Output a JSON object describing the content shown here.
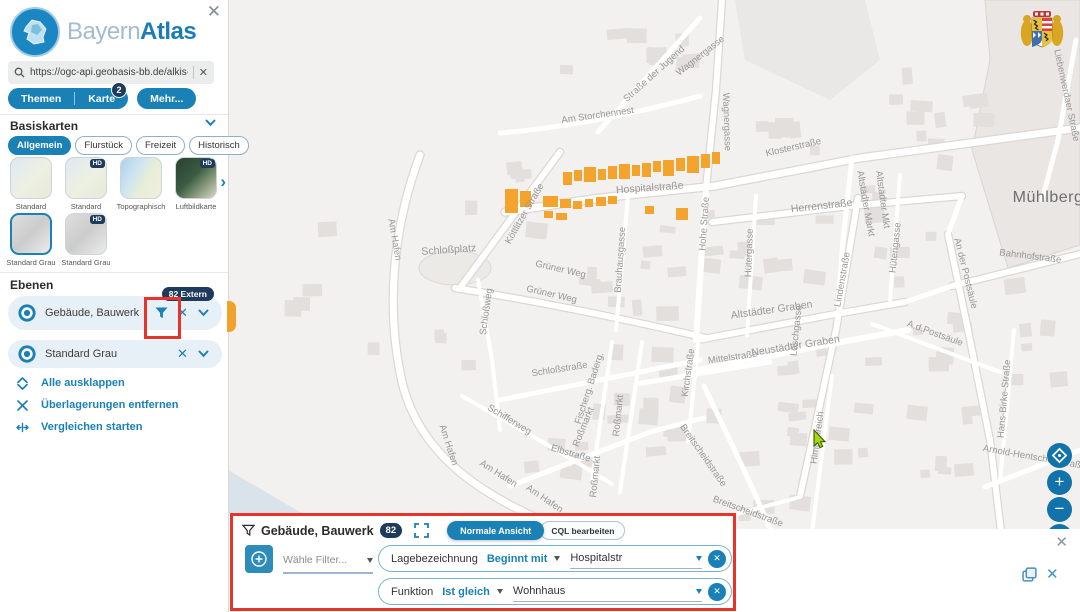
{
  "colors": {
    "brand": "#1a81b6",
    "badge_navy": "#1e3a5c",
    "highlight_orange": "#f4a42c",
    "annotation_red": "#e8332b"
  },
  "glyphs": {
    "close": "✕",
    "chevron_right": "›",
    "zoom_in": "+",
    "zoom_out": "−"
  },
  "sidebar": {
    "brand": {
      "part1": "Bayern",
      "part2": "Atlas"
    },
    "search": {
      "value": "https://ogc-api.geobasis-bb.de/alkis-verein"
    },
    "tabs": [
      {
        "label": "Themen",
        "badge": null
      },
      {
        "label": "Karte",
        "badge": "2"
      },
      {
        "label": "Mehr...",
        "badge": null
      }
    ],
    "basiskarten": {
      "title": "Basiskarten",
      "hd_badge": "HD",
      "chips": [
        {
          "label": "Allgemein",
          "active": true
        },
        {
          "label": "Flurstück",
          "active": false
        },
        {
          "label": "Freizeit",
          "active": false
        },
        {
          "label": "Historisch",
          "active": false
        }
      ],
      "thumbnails": [
        {
          "label": "Standard",
          "variant": "standard",
          "hd": false,
          "selected": false,
          "row": 1
        },
        {
          "label": "Standard",
          "variant": "standard",
          "hd": true,
          "selected": false,
          "row": 1
        },
        {
          "label": "Topographisch",
          "variant": "topo",
          "hd": false,
          "selected": false,
          "row": 1
        },
        {
          "label": "Luftbildkarte",
          "variant": "luft",
          "hd": true,
          "selected": false,
          "row": 1
        },
        {
          "label": "Standard Grau",
          "variant": "grau",
          "hd": false,
          "selected": true,
          "row": 2
        },
        {
          "label": "Standard Grau",
          "variant": "grau",
          "hd": true,
          "selected": false,
          "row": 2
        }
      ]
    },
    "ebenen": {
      "title": "Ebenen",
      "layers": [
        {
          "label": "Gebäude, Bauwerk",
          "badge": "82 Extern",
          "has_filter": true
        },
        {
          "label": "Standard Grau",
          "badge": null,
          "has_filter": false
        }
      ],
      "actions": [
        {
          "label": "Alle ausklappen",
          "icon": "expand-all-icon"
        },
        {
          "label": "Überlagerungen entfernen",
          "icon": "remove-overlays-icon"
        },
        {
          "label": "Vergleichen starten",
          "icon": "compare-icon"
        }
      ]
    }
  },
  "filter_panel": {
    "title": "Gebäude, Bauwerk",
    "count_badge": "82",
    "view_toggle": [
      {
        "label": "Normale Ansicht",
        "active": true
      },
      {
        "label": "CQL bearbeiten",
        "active": false
      }
    ],
    "add_filter_placeholder": "Wähle Filter...",
    "filters": [
      {
        "field": "Lagebezeichnung",
        "operator": "Beginnt mit",
        "value": "Hospitalstr"
      },
      {
        "field": "Funktion",
        "operator": "Ist gleich",
        "value": "Wohnhaus"
      }
    ]
  },
  "map": {
    "place_labels": [
      {
        "text": "Mühlberg",
        "x": 1048,
        "y": 202,
        "rot": 0,
        "size": 16
      }
    ],
    "street_labels": [
      {
        "text": "Wagnergasse",
        "x": 702,
        "y": 58,
        "rot": -38
      },
      {
        "text": "Wagnergasse",
        "x": 724,
        "y": 122,
        "rot": 88
      },
      {
        "text": "Straße der Jugend",
        "x": 656,
        "y": 76,
        "rot": -42
      },
      {
        "text": "Am Storchennest",
        "x": 598,
        "y": 118,
        "rot": -8
      },
      {
        "text": "Klosterstraße",
        "x": 794,
        "y": 150,
        "rot": -13
      },
      {
        "text": "Hospitalstraße",
        "x": 650,
        "y": 191,
        "rot": -4,
        "size": 10.5
      },
      {
        "text": "Herrenstraße",
        "x": 822,
        "y": 209,
        "rot": -6,
        "size": 10.5
      },
      {
        "text": "Altstädter Markt",
        "x": 863,
        "y": 204,
        "rot": 80
      },
      {
        "text": "Altstädter Mkt",
        "x": 880,
        "y": 200,
        "rot": 82
      },
      {
        "text": "Liebenwerdaer Straße",
        "x": 1064,
        "y": 96,
        "rot": 78
      },
      {
        "text": "Hohe Straße",
        "x": 707,
        "y": 224,
        "rot": -86
      },
      {
        "text": "Hütergasse",
        "x": 752,
        "y": 253,
        "rot": -88
      },
      {
        "text": "Hütengasse",
        "x": 898,
        "y": 248,
        "rot": -84
      },
      {
        "text": "Brauhausgasse",
        "x": 623,
        "y": 260,
        "rot": -86
      },
      {
        "text": "Köttlitzer Straße",
        "x": 527,
        "y": 215,
        "rot": -60
      },
      {
        "text": "Schloßplatz",
        "x": 449,
        "y": 253,
        "rot": -4,
        "size": 10.5
      },
      {
        "text": "Grüner Weg",
        "x": 560,
        "y": 272,
        "rot": 13
      },
      {
        "text": "Grüner Weg",
        "x": 551,
        "y": 297,
        "rot": 13
      },
      {
        "text": "Schloßweg",
        "x": 489,
        "y": 312,
        "rot": -82
      },
      {
        "text": "Am Hafen",
        "x": 392,
        "y": 240,
        "rot": 80
      },
      {
        "text": "Altstädter Graben",
        "x": 772,
        "y": 313,
        "rot": -8,
        "size": 10.5
      },
      {
        "text": "Neustädter Graben",
        "x": 796,
        "y": 349,
        "rot": -9,
        "size": 10.5
      },
      {
        "text": "Mittelstraße",
        "x": 733,
        "y": 360,
        "rot": -8
      },
      {
        "text": "Lindenstraße",
        "x": 845,
        "y": 280,
        "rot": -80
      },
      {
        "text": "A.d.Postsäule",
        "x": 934,
        "y": 336,
        "rot": 20
      },
      {
        "text": "An der Postsäule",
        "x": 963,
        "y": 274,
        "rot": 76
      },
      {
        "text": "Bahnhofstraße",
        "x": 1030,
        "y": 259,
        "rot": 7
      },
      {
        "text": "Kirchstraße",
        "x": 691,
        "y": 373,
        "rot": -82
      },
      {
        "text": "Löschgasse",
        "x": 799,
        "y": 331,
        "rot": -84
      },
      {
        "text": "Schloßstraße",
        "x": 560,
        "y": 372,
        "rot": -9
      },
      {
        "text": "Fischerg. Baderg.",
        "x": 592,
        "y": 389,
        "rot": -72
      },
      {
        "text": "Roßmarkt",
        "x": 586,
        "y": 428,
        "rot": -68
      },
      {
        "text": "Roßmarkt",
        "x": 621,
        "y": 416,
        "rot": -84
      },
      {
        "text": "Roßmarkt",
        "x": 598,
        "y": 477,
        "rot": -84
      },
      {
        "text": "Schifferweg",
        "x": 508,
        "y": 422,
        "rot": 31
      },
      {
        "text": "Elbstraße",
        "x": 570,
        "y": 456,
        "rot": 16
      },
      {
        "text": "Am Hafen",
        "x": 497,
        "y": 476,
        "rot": 32
      },
      {
        "text": "Am Hafen",
        "x": 543,
        "y": 501,
        "rot": 34
      },
      {
        "text": "Am Hafen",
        "x": 446,
        "y": 446,
        "rot": 72
      },
      {
        "text": "Breitscheidstraße",
        "x": 701,
        "y": 457,
        "rot": 55
      },
      {
        "text": "Breitscheidstraße",
        "x": 747,
        "y": 514,
        "rot": 20
      },
      {
        "text": "Himmelreich",
        "x": 820,
        "y": 438,
        "rot": -82
      },
      {
        "text": "Hans-Birke-Straße",
        "x": 1007,
        "y": 399,
        "rot": -85
      },
      {
        "text": "Arnold-Hentschel-Straße",
        "x": 1034,
        "y": 460,
        "rot": 10
      }
    ]
  }
}
